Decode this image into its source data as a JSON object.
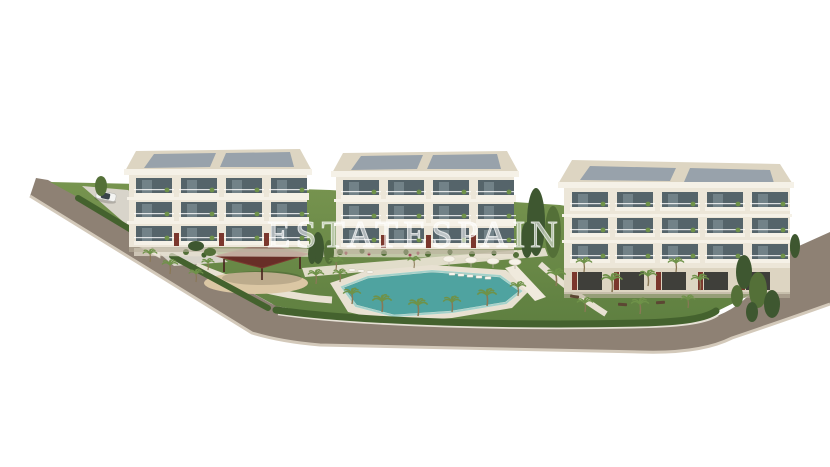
{
  "scene": {
    "watermark": "ESTATESPAIN",
    "alt_text": "Aerial 3D architectural render of a residential complex: three cream apartment buildings with rooftop solar panels, landscaped gardens with palm trees, a turquoise swimming pool with sun loungers and umbrellas, a dark-red wooden gazebo over a sand playground, perimeter road with a white car at the entrance, on a plain white background"
  },
  "palette": {
    "background": "#ffffff",
    "road": "#8e8174",
    "road_curb": "#d3c9ba",
    "driveway": "#d8d4ca",
    "lawn_light": "#77944f",
    "lawn_dark": "#5e7f40",
    "hedge": "#44622e",
    "tree_dark": "#3e5730",
    "tree_mid": "#547038",
    "palm_green": "#6f9249",
    "palm_trunk": "#8a7856",
    "pool_water": "#4fa3a0",
    "pool_light": "#8fcac4",
    "deck": "#e8e1d2",
    "sand": "#dbc7a4",
    "facade": "#ece6d8",
    "facade_shade": "#ddd5c2",
    "parapet": "#f5f1e7",
    "window": "#55646a",
    "panel": "#98a2ab",
    "pergola": "#682e27",
    "accent_red": "#7b372d",
    "car_body": "#f4f4f2",
    "bench": "#5c4733",
    "flower": "#a04458"
  }
}
